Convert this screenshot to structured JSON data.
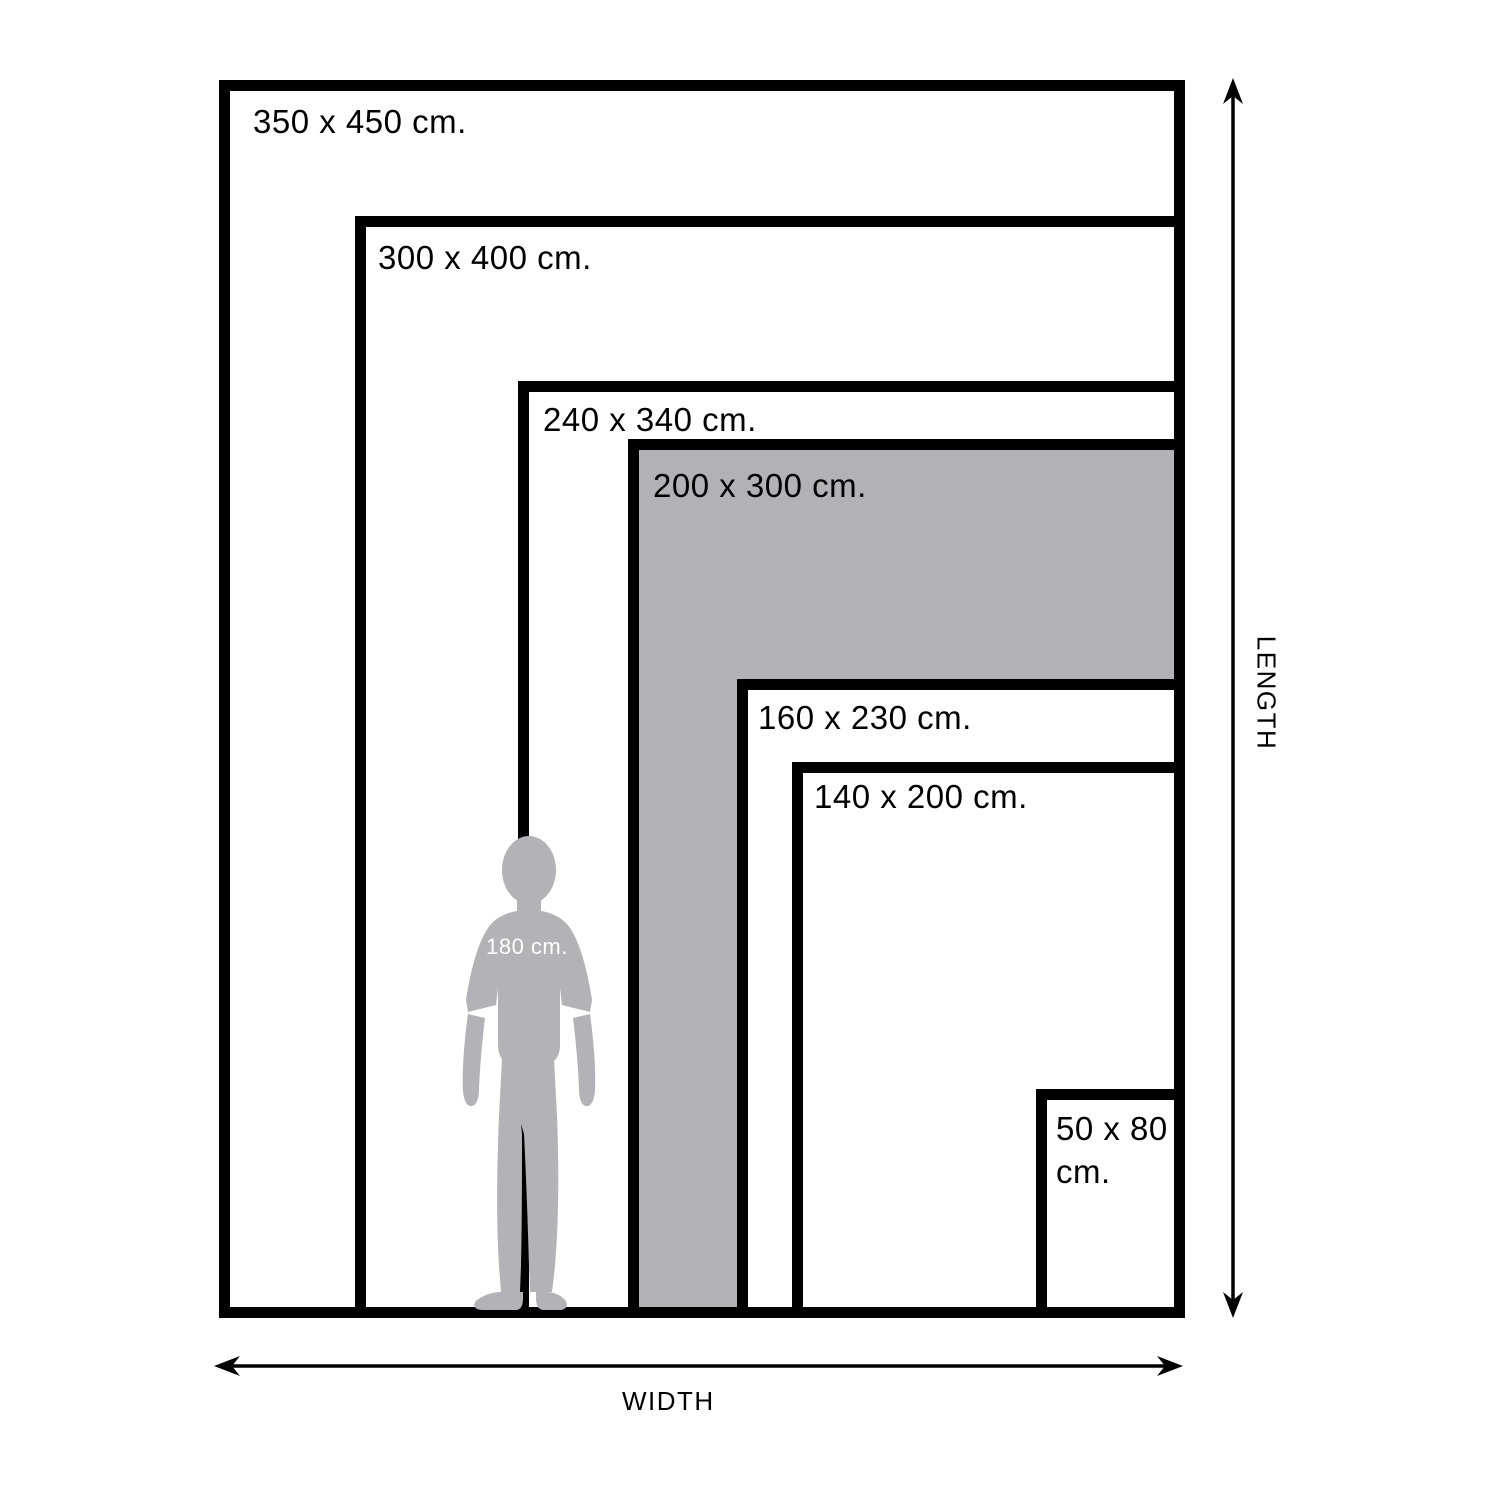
{
  "diagram": {
    "sizes": [
      {
        "label": "350 x 450 cm.",
        "width_cm": 350,
        "length_cm": 450,
        "highlighted": false
      },
      {
        "label": "300 x 400 cm.",
        "width_cm": 300,
        "length_cm": 400,
        "highlighted": false
      },
      {
        "label": "240 x 340 cm.",
        "width_cm": 240,
        "length_cm": 340,
        "highlighted": false
      },
      {
        "label": "200 x 300 cm.",
        "width_cm": 200,
        "length_cm": 300,
        "highlighted": true
      },
      {
        "label": "160 x 230 cm.",
        "width_cm": 160,
        "length_cm": 230,
        "highlighted": false
      },
      {
        "label": "140 x 200 cm.",
        "width_cm": 140,
        "length_cm": 200,
        "highlighted": false
      },
      {
        "label": "50 x 80 cm.",
        "width_cm": 50,
        "length_cm": 80,
        "highlighted": false
      }
    ],
    "person": {
      "label": "180 cm.",
      "height_cm": 180
    },
    "axes": {
      "width_label": "WIDTH",
      "length_label": "LENGTH"
    },
    "colors": {
      "outline": "#000000",
      "highlight_fill": "#b2b1b5",
      "person_fill": "#b3b2b6",
      "background": "#ffffff",
      "label_text": "#000000",
      "person_label_text": "#ffffff"
    }
  }
}
